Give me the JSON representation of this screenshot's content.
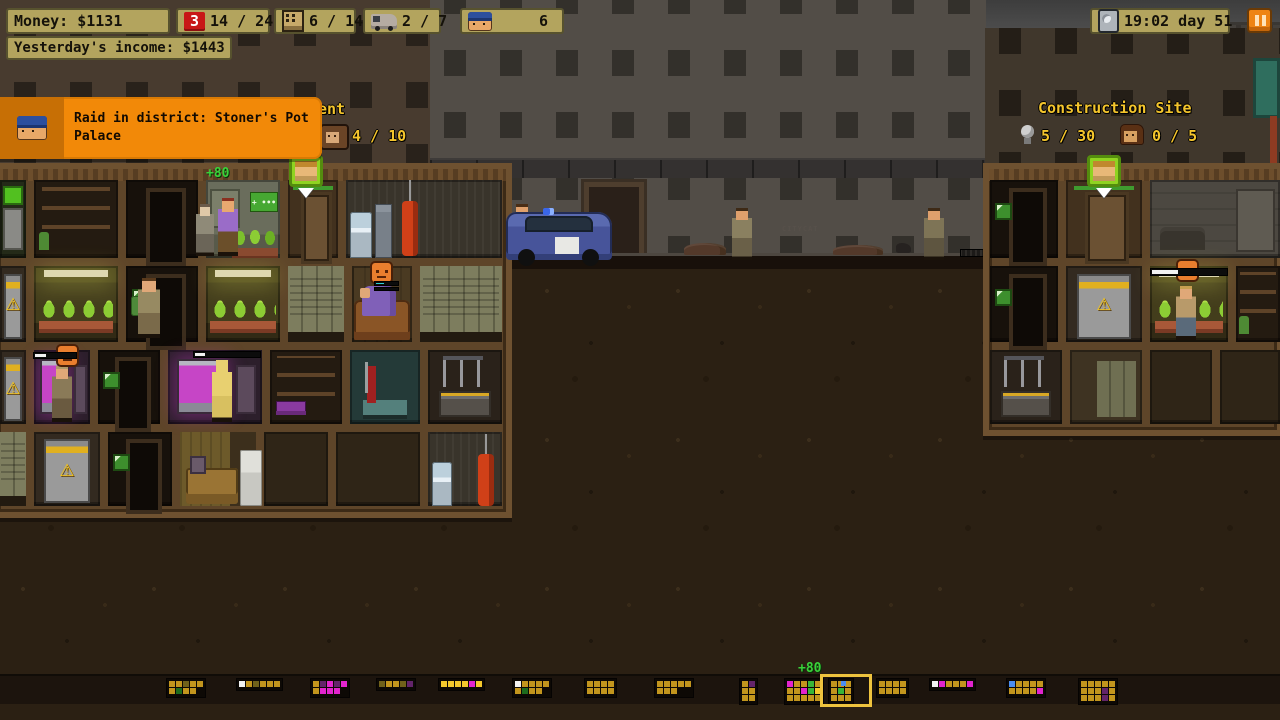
{
  "hud": {
    "money": "Money: $1131",
    "income": "Yesterday's income: $1443",
    "raid_count": "3",
    "raid_ratio": "14 / 24",
    "building_ratio": "6 / 14",
    "van_ratio": "2 / 7",
    "police_count": "6",
    "time": "19:02 day 51"
  },
  "notification": {
    "message": "Raid in district: Stoner's Pot Palace"
  },
  "districts": {
    "apartment_label_partial": "ent",
    "apartment_tenants": "4 / 10",
    "construction_title": "Construction Site",
    "construction_materials": "5 / 30",
    "construction_workers": "0 / 5"
  },
  "colors": {
    "hud_panel": "#b3a45e",
    "alert_red": "#c81717",
    "notification_orange": "#f28908",
    "label_yellow": "#f4c52c",
    "pause_orange": "#ee8414",
    "floater_green": "#3ad13a",
    "selection_yellow": "#eec33e"
  },
  "minimap": {
    "top": 678,
    "selected_income": "+80",
    "districts": [
      {
        "x": 166,
        "rows": [
          "yyoyy",
          "yGyy."
        ]
      },
      {
        "x": 236,
        "rows": [
          "wyoyyy"
        ]
      },
      {
        "x": 310,
        "rows": [
          "ypmpm",
          "ymmm."
        ]
      },
      {
        "x": 376,
        "rows": [
          "oyyop"
        ]
      },
      {
        "x": 438,
        "rows": [
          "YYYYmY"
        ]
      },
      {
        "x": 512,
        "rows": [
          "wyyyy",
          "yGyy."
        ]
      },
      {
        "x": 584,
        "rows": [
          "yyyy",
          "yyyy"
        ]
      },
      {
        "x": 654,
        "rows": [
          "yyyyy",
          "yyy.."
        ]
      },
      {
        "x": 739,
        "rows": [
          "yp",
          "yy",
          "yy"
        ]
      },
      {
        "x": 784,
        "rows": [
          "myygy",
          "yymgY",
          "yyyyy"
        ]
      },
      {
        "x": 828,
        "selected": true,
        "rows": [
          "yyy",
          "ygy",
          "yyy"
        ]
      },
      {
        "x": 876,
        "rows": [
          "yyyy",
          "yyyy"
        ]
      },
      {
        "x": 929,
        "rows": [
          "wmyyym"
        ]
      },
      {
        "x": 1006,
        "rows": [
          "byyyy",
          "yyyym"
        ]
      },
      {
        "x": 1078,
        "rows": [
          "yyyyy",
          "yyypy",
          "yyypy"
        ]
      }
    ]
  },
  "scene": {
    "items": [
      {
        "t": "skyband",
        "x": 0,
        "y": 0,
        "w": 1280,
        "h": 32
      },
      {
        "t": "moon",
        "x": 502,
        "y": 0,
        "w": 42,
        "h": 17
      },
      {
        "t": "sil",
        "x": 430,
        "y": 98,
        "w": 96,
        "h": 162
      },
      {
        "t": "sil",
        "x": 530,
        "y": 128,
        "w": 106,
        "h": 132
      },
      {
        "t": "sil",
        "x": 618,
        "y": 92,
        "w": 146,
        "h": 168
      },
      {
        "t": "sil",
        "x": 766,
        "y": 118,
        "w": 96,
        "h": 142
      },
      {
        "t": "sil",
        "x": 855,
        "y": 95,
        "w": 132,
        "h": 165
      },
      {
        "t": "sil",
        "x": 1188,
        "y": 22,
        "w": 92,
        "h": 145
      },
      {
        "t": "crane-jib",
        "x": 556,
        "y": 28,
        "w": 724,
        "h": 46
      },
      {
        "t": "crane-ballast",
        "x": 556,
        "y": 72,
        "w": 46,
        "h": 52
      },
      {
        "t": "crane-tower",
        "x": 704,
        "y": 0,
        "w": 52,
        "h": 262
      },
      {
        "t": "crane-cable",
        "x": 1134,
        "y": 74,
        "w": 3,
        "h": 150
      },
      {
        "t": "crane-hook",
        "x": 1124,
        "y": 222,
        "w": 22,
        "h": 30
      },
      {
        "t": "leftfacade",
        "x": 0,
        "y": 0,
        "w": 512,
        "h": 170,
        "css": "--fc:#483b2f;--wc:#29221b;"
      },
      {
        "t": "midfacade",
        "x": 430,
        "y": 0,
        "w": 556,
        "h": 262,
        "css": "--fc:#524d47;--wc:#33302b;"
      },
      {
        "t": "fence",
        "x": 430,
        "y": 158,
        "w": 556,
        "h": 20
      },
      {
        "t": "middoor",
        "x": 584,
        "y": 182,
        "w": 60,
        "h": 76
      },
      {
        "t": "rightfacade",
        "x": 985,
        "y": 28,
        "w": 295,
        "h": 150,
        "css": "--fc:#40372c;--wc:#241e17;"
      },
      {
        "t": "tealdoor",
        "x": 1253,
        "y": 58,
        "w": 27,
        "h": 60
      },
      {
        "t": "pipe",
        "x": 1270,
        "y": 116,
        "w": 7,
        "h": 62
      },
      {
        "t": "dirt",
        "x": 0,
        "y": 260,
        "w": 1280,
        "h": 460
      },
      {
        "t": "street",
        "x": 425,
        "y": 253,
        "w": 560,
        "h": 16
      },
      {
        "t": "rubble",
        "x": 684,
        "y": 243,
        "w": 42,
        "h": 12
      },
      {
        "t": "rubble",
        "x": 833,
        "y": 245,
        "w": 50,
        "h": 10
      },
      {
        "t": "rubble",
        "x": 486,
        "y": 249,
        "w": 30,
        "h": 8
      },
      {
        "t": "cat",
        "x": 896,
        "y": 243,
        "w": 15,
        "h": 10
      },
      {
        "t": "grate",
        "x": 960,
        "y": 249,
        "w": 24,
        "h": 8
      },
      {
        "t": "graffiti",
        "x": 782,
        "y": 225,
        "w": 60,
        "h": 10,
        "txt": "CITYCAT"
      },
      {
        "t": "complex",
        "x": -8,
        "y": 163,
        "w": 520,
        "h": 355
      },
      {
        "t": "complex",
        "x": 983,
        "y": 163,
        "w": 300,
        "h": 273
      },
      {
        "t": "room",
        "cls": "k-vending",
        "x": 0,
        "y": 180,
        "w": 26,
        "h": 78,
        "i": true
      },
      {
        "t": "room",
        "cls": "k-shelves",
        "x": 34,
        "y": 180,
        "w": 84,
        "h": 78,
        "i": true
      },
      {
        "t": "room",
        "cls": "k-dark",
        "x": 126,
        "y": 180,
        "w": 72,
        "h": 78,
        "i": true
      },
      {
        "t": "room",
        "cls": "k-office",
        "x": 206,
        "y": 180,
        "w": 74,
        "h": 78,
        "i": true
      },
      {
        "t": "room",
        "cls": "k-entry",
        "x": 288,
        "y": 180,
        "w": 50,
        "h": 78,
        "i": true
      },
      {
        "t": "room",
        "cls": "k-utility",
        "x": 346,
        "y": 180,
        "w": 156,
        "h": 78,
        "i": true
      },
      {
        "t": "room",
        "cls": "k-machine",
        "x": 0,
        "y": 266,
        "w": 26,
        "h": 76,
        "i": true
      },
      {
        "t": "room",
        "cls": "k-grow",
        "x": 34,
        "y": 266,
        "w": 84,
        "h": 76,
        "i": true
      },
      {
        "t": "room",
        "cls": "k-dark k-pic",
        "x": 126,
        "y": 266,
        "w": 72,
        "h": 76,
        "i": true
      },
      {
        "t": "room",
        "cls": "k-grow",
        "x": 206,
        "y": 266,
        "w": 74,
        "h": 76,
        "i": true
      },
      {
        "t": "room",
        "cls": "k-lockers",
        "x": 288,
        "y": 266,
        "w": 56,
        "h": 76,
        "i": true
      },
      {
        "t": "room",
        "cls": "k-wood",
        "x": 352,
        "y": 266,
        "w": 60,
        "h": 76,
        "i": true
      },
      {
        "t": "room",
        "cls": "k-lockers",
        "x": 420,
        "y": 266,
        "w": 82,
        "h": 76,
        "i": true
      },
      {
        "t": "room",
        "cls": "k-machine",
        "x": 0,
        "y": 350,
        "w": 26,
        "h": 74,
        "i": true
      },
      {
        "t": "room",
        "cls": "k-lab",
        "x": 34,
        "y": 350,
        "w": 56,
        "h": 74,
        "i": true
      },
      {
        "t": "room",
        "cls": "k-dark k-pic",
        "x": 98,
        "y": 350,
        "w": 62,
        "h": 74,
        "i": true
      },
      {
        "t": "room",
        "cls": "k-lab",
        "x": 168,
        "y": 350,
        "w": 94,
        "h": 74,
        "i": true
      },
      {
        "t": "room",
        "cls": "k-shelfpurple",
        "x": 270,
        "y": 350,
        "w": 72,
        "h": 74,
        "i": true
      },
      {
        "t": "room",
        "cls": "k-medical",
        "x": 350,
        "y": 350,
        "w": 70,
        "h": 74,
        "i": true
      },
      {
        "t": "room",
        "cls": "k-workshop",
        "x": 428,
        "y": 350,
        "w": 74,
        "h": 74,
        "i": true
      },
      {
        "t": "room",
        "cls": "k-lockers",
        "x": 0,
        "y": 432,
        "w": 26,
        "h": 74,
        "i": true
      },
      {
        "t": "room",
        "cls": "k-machine",
        "x": 34,
        "y": 432,
        "w": 66,
        "h": 74,
        "i": true
      },
      {
        "t": "room",
        "cls": "k-dark k-pic",
        "x": 108,
        "y": 432,
        "w": 64,
        "h": 74,
        "i": true
      },
      {
        "t": "room",
        "cls": "k-living",
        "x": 180,
        "y": 432,
        "w": 76,
        "h": 74,
        "i": true
      },
      {
        "t": "room",
        "cls": "k-empty",
        "x": 264,
        "y": 432,
        "w": 64,
        "h": 74,
        "i": true
      },
      {
        "t": "room",
        "cls": "k-empty",
        "x": 336,
        "y": 432,
        "w": 84,
        "h": 74,
        "i": true
      },
      {
        "t": "room",
        "cls": "k-utility2",
        "x": 428,
        "y": 432,
        "w": 74,
        "h": 74,
        "i": true
      },
      {
        "t": "room",
        "cls": "k-dark k-pic",
        "x": 990,
        "y": 180,
        "w": 68,
        "h": 78,
        "i": true
      },
      {
        "t": "room",
        "cls": "k-entry",
        "x": 1066,
        "y": 180,
        "w": 76,
        "h": 78,
        "i": true
      },
      {
        "t": "room",
        "cls": "k-warehouse",
        "x": 1150,
        "y": 180,
        "w": 130,
        "h": 78,
        "i": true
      },
      {
        "t": "room",
        "cls": "k-dark k-pic",
        "x": 990,
        "y": 266,
        "w": 68,
        "h": 76,
        "i": true
      },
      {
        "t": "room",
        "cls": "k-machine",
        "x": 1066,
        "y": 266,
        "w": 76,
        "h": 76,
        "i": true
      },
      {
        "t": "room",
        "cls": "k-grow",
        "x": 1150,
        "y": 266,
        "w": 78,
        "h": 76,
        "i": true
      },
      {
        "t": "room",
        "cls": "k-shelves",
        "x": 1236,
        "y": 266,
        "w": 44,
        "h": 76,
        "i": true
      },
      {
        "t": "room",
        "cls": "k-workshop",
        "x": 990,
        "y": 350,
        "w": 72,
        "h": 74,
        "i": true
      },
      {
        "t": "room",
        "cls": "k-lockwood",
        "x": 1070,
        "y": 350,
        "w": 72,
        "h": 74,
        "i": true
      },
      {
        "t": "room",
        "cls": "k-empty",
        "x": 1150,
        "y": 350,
        "w": 62,
        "h": 74,
        "i": true
      },
      {
        "t": "room",
        "cls": "k-empty",
        "x": 1220,
        "y": 350,
        "w": 60,
        "h": 74,
        "i": true
      },
      {
        "t": "plants3",
        "x": 232,
        "y": 226,
        "w": 46,
        "h": 32
      },
      {
        "t": "cooler",
        "x": 350,
        "y": 212,
        "w": 22,
        "h": 46
      },
      {
        "t": "cabinet",
        "x": 375,
        "y": 204,
        "w": 17,
        "h": 54
      },
      {
        "t": "punchbag",
        "x": 400,
        "y": 180,
        "w": 20,
        "h": 76
      },
      {
        "t": "cooler",
        "x": 432,
        "y": 462,
        "w": 20,
        "h": 44
      },
      {
        "t": "punchbag",
        "x": 476,
        "y": 434,
        "w": 20,
        "h": 72
      },
      {
        "t": "couch",
        "x": 354,
        "y": 300,
        "w": 56,
        "h": 40
      },
      {
        "t": "sleeper",
        "x": 362,
        "y": 286,
        "w": 34,
        "h": 30
      },
      {
        "t": "bench",
        "x": 186,
        "y": 468,
        "w": 52,
        "h": 36
      },
      {
        "t": "fridge",
        "x": 240,
        "y": 450,
        "w": 22,
        "h": 56
      },
      {
        "t": "pic",
        "x": 190,
        "y": 456,
        "w": 16,
        "h": 18
      },
      {
        "t": "person",
        "n": "tenant-grey",
        "x": 196,
        "y": 204,
        "w": 18,
        "h": 52,
        "css": "--hair:#6b5b4b;--skin:#e0c9a8;--shirt:#8f8a78;--pants:#6b6558;"
      },
      {
        "t": "person",
        "n": "dealer-purple",
        "x": 218,
        "y": 198,
        "w": 20,
        "h": 58,
        "css": "--hair:#8a3020;--skin:#e8a870;--shirt:#9a6cc8;--pants:#6b4f2a;"
      },
      {
        "t": "sack",
        "x": 131,
        "y": 296,
        "w": 16,
        "h": 20
      },
      {
        "t": "person",
        "n": "carrier",
        "x": 138,
        "y": 278,
        "w": 22,
        "h": 60,
        "css": "--hair:#5a3a1c;--skin:#e0a878;--shirt:#978a62;--pants:#7a6a4a;"
      },
      {
        "t": "person",
        "n": "lab-worker",
        "x": 52,
        "y": 366,
        "w": 20,
        "h": 56,
        "css": "--hair:#b09a6a;--skin:#e0a878;--shirt:#8a7a58;--pants:#6a5a40;"
      },
      {
        "t": "person",
        "n": "undressed-tenant",
        "x": 212,
        "y": 360,
        "w": 20,
        "h": 62,
        "css": "--hair:#e8d070;--skin:#e8d070;--shirt:#e8d070;--pants:#d8c060;"
      },
      {
        "t": "person",
        "n": "pedestrian",
        "x": 512,
        "y": 204,
        "w": 20,
        "h": 54,
        "css": "--hair:#4a2e16;--skin:#dfa06c;--shirt:#7c7250;--pants:#5c5340;"
      },
      {
        "t": "firecan",
        "x": 526,
        "y": 212,
        "w": 14,
        "h": 18
      },
      {
        "t": "car",
        "n": "police-car",
        "x": 506,
        "y": 212,
        "w": 106,
        "h": 48,
        "i": true
      },
      {
        "t": "siren",
        "x": 543,
        "y": 208,
        "w": 11,
        "h": 7
      },
      {
        "t": "person",
        "n": "pedestrian",
        "x": 732,
        "y": 208,
        "w": 20,
        "h": 52,
        "css": "--hair:#3e2a16;--skin:#dfa06c;--shirt:#8a8060;--pants:#6a6048;"
      },
      {
        "t": "person",
        "n": "pedestrian",
        "x": 924,
        "y": 208,
        "w": 20,
        "h": 52,
        "css": "--hair:#3e2a16;--skin:#dfa06c;--shirt:#7e7456;--pants:#5e5540;"
      },
      {
        "t": "person",
        "n": "grow-worker",
        "x": 1176,
        "y": 286,
        "w": 20,
        "h": 54,
        "css": "--hair:#c8a050;--skin:#e0a878;--shirt:#b89a6a;--pants:#5a6a7a;"
      },
      {
        "t": "floater",
        "n": "room-income-floater",
        "x": 206,
        "y": 166,
        "w": 60,
        "h": 14,
        "txt": "+80"
      },
      {
        "t": "badge",
        "n": "selected-character-badge",
        "x": 289,
        "y": 155,
        "w": 34,
        "h": 32,
        "i": true
      },
      {
        "t": "badge",
        "n": "selected-character-badge",
        "x": 1087,
        "y": 155,
        "w": 34,
        "h": 32,
        "i": true
      },
      {
        "t": "emoji",
        "n": "mood-angry-icon",
        "x": 370,
        "y": 261,
        "w": 23,
        "h": 23
      },
      {
        "t": "bar",
        "n": "need-bar",
        "x": 374,
        "y": 281,
        "w": 25,
        "h": 5,
        "css": "--seg:linear-gradient(90deg,#2fd3d3 0 38%,#0c0c0c 38%);"
      },
      {
        "t": "bar",
        "n": "need-bar",
        "x": 374,
        "y": 287,
        "w": 25,
        "h": 4,
        "css": "--seg:linear-gradient(90deg,#35e035 0 65%,#0c0c0c 65%);"
      },
      {
        "t": "emoji",
        "n": "mood-angry-icon",
        "x": 56,
        "y": 344,
        "w": 23,
        "h": 23
      },
      {
        "t": "bar",
        "n": "progress-bar",
        "x": 33,
        "y": 352,
        "w": 44,
        "h": 7,
        "css": "--seg:linear-gradient(90deg,#f2f2f2 0 28%,#0c0c0c 28%);"
      },
      {
        "t": "bar",
        "n": "progress-bar",
        "x": 193,
        "y": 351,
        "w": 68,
        "h": 7,
        "css": "--seg:linear-gradient(90deg,#f2f2f2 0 16%,#0c0c0c 16%);"
      },
      {
        "t": "emoji",
        "n": "mood-angry-icon",
        "x": 1176,
        "y": 259,
        "w": 23,
        "h": 23
      },
      {
        "t": "bar",
        "n": "progress-bar",
        "x": 1150,
        "y": 268,
        "w": 78,
        "h": 8,
        "css": "--seg:linear-gradient(90deg,#f2f2f2 0 35%,#0c0c0c 35%);"
      },
      {
        "t": "mapband",
        "x": 0,
        "y": 674,
        "w": 1280,
        "h": 30
      },
      {
        "t": "mapsel",
        "n": "minimap-selection",
        "x": 820,
        "y": 674,
        "w": 52,
        "h": 33,
        "i": true
      },
      {
        "t": "px",
        "n": "minimap-marker",
        "x": 841,
        "y": 681,
        "w": 5,
        "h": 5,
        "css": "background:#4b8df0;"
      },
      {
        "t": "floater",
        "n": "minimap-income-floater",
        "x": 798,
        "y": 661,
        "w": 44,
        "h": 14,
        "txt": "+80"
      }
    ]
  }
}
